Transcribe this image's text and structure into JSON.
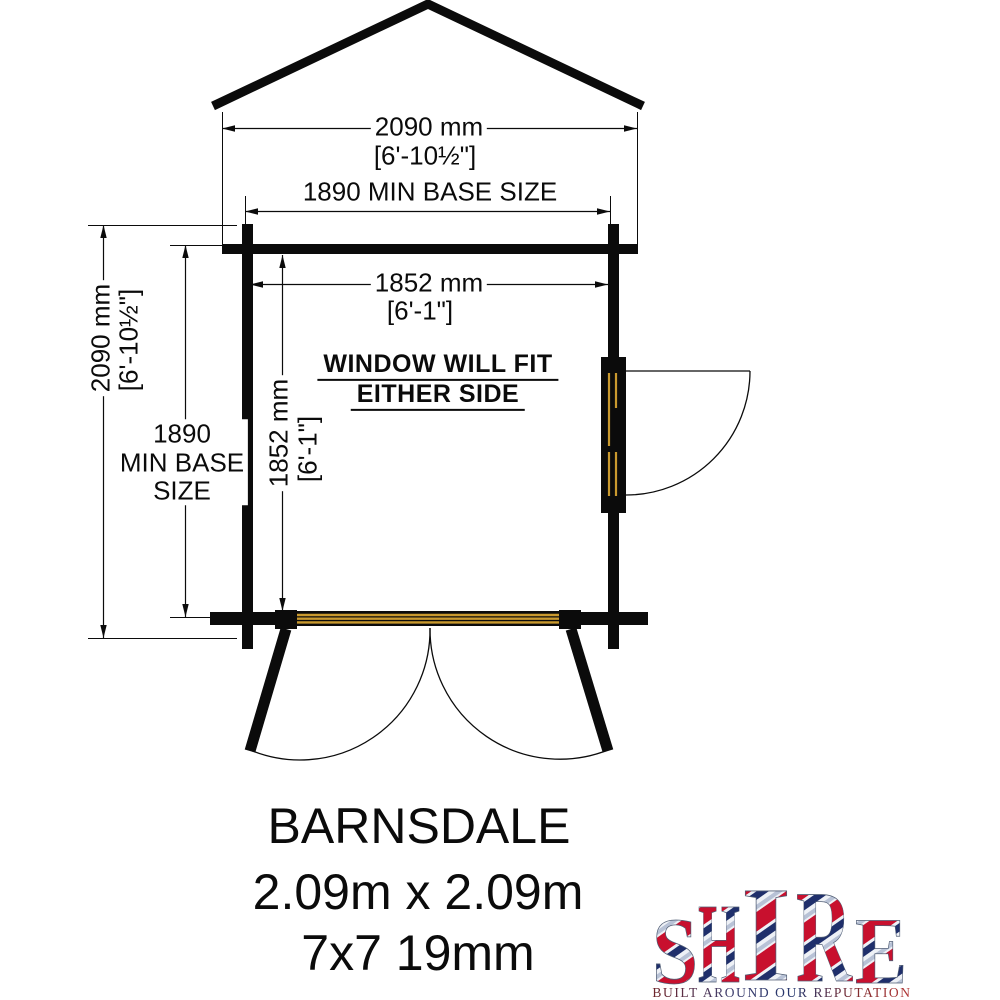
{
  "meta": {
    "css_vars": {
      "--bg": "#ffffff",
      "--ink": "#0b0b0b",
      "--wood": "#c9992e",
      "--flag-red": "#c8102e",
      "--flag-blue": "#1f2f6b",
      "--flag-silver": "#b8c2d6"
    }
  },
  "diagram": {
    "dim_top_outer": {
      "mm": "2090 mm",
      "ft": "[6'-10½\"]"
    },
    "dim_top_base": "1890 MIN BASE SIZE",
    "dim_inner_width": {
      "mm": "1852 mm",
      "ft": "[6'-1\"]"
    },
    "dim_left_outer": {
      "mm": "2090 mm",
      "ft": "[6'-10½\"]"
    },
    "dim_left_base": {
      "line1": "1890",
      "line2": "MIN BASE",
      "line3": "SIZE"
    },
    "dim_inner_height": {
      "mm": "1852 mm",
      "ft": "[6'-1\"]"
    },
    "note_line1": "WINDOW WILL FIT",
    "note_line2": "EITHER SIDE"
  },
  "product": {
    "name": "BARNSDALE",
    "dimensions": "2.09m x 2.09m",
    "spec": "7x7 19mm"
  },
  "logo": {
    "letters": [
      "S",
      "H",
      "I",
      "R",
      "E"
    ],
    "tagline": "BUILT AROUND OUR REPUTATION"
  }
}
